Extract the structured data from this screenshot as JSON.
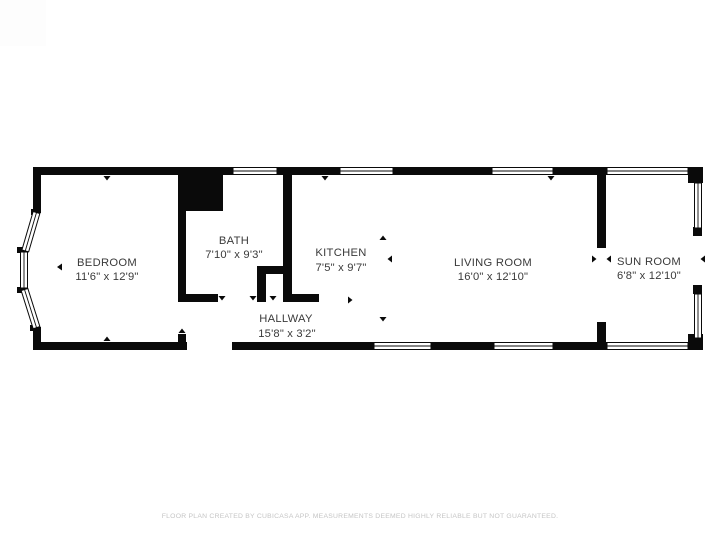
{
  "page": {
    "background_color": "#ffffff",
    "wall_color": "#0a0a0a",
    "label_color": "#3a3a3a",
    "disclaimer_color": "#c5c5c5"
  },
  "floor_plan": {
    "rooms": [
      {
        "name": "BEDROOM",
        "dims": "11'6\" x 12'9\""
      },
      {
        "name": "BATH",
        "dims": "7'10\" x 9'3\""
      },
      {
        "name": "KITCHEN",
        "dims": "7'5\" x 9'7\""
      },
      {
        "name": "LIVING ROOM",
        "dims": "16'0\" x 12'10\""
      },
      {
        "name": "SUN ROOM",
        "dims": "6'8\" x 12'10\""
      },
      {
        "name": "HALLWAY",
        "dims": "15'8\" x 3'2\""
      }
    ]
  },
  "footer": {
    "disclaimer": "FLOOR PLAN CREATED BY CUBICASA APP. MEASUREMENTS DEEMED HIGHLY RELIABLE BUT NOT GUARANTEED."
  }
}
